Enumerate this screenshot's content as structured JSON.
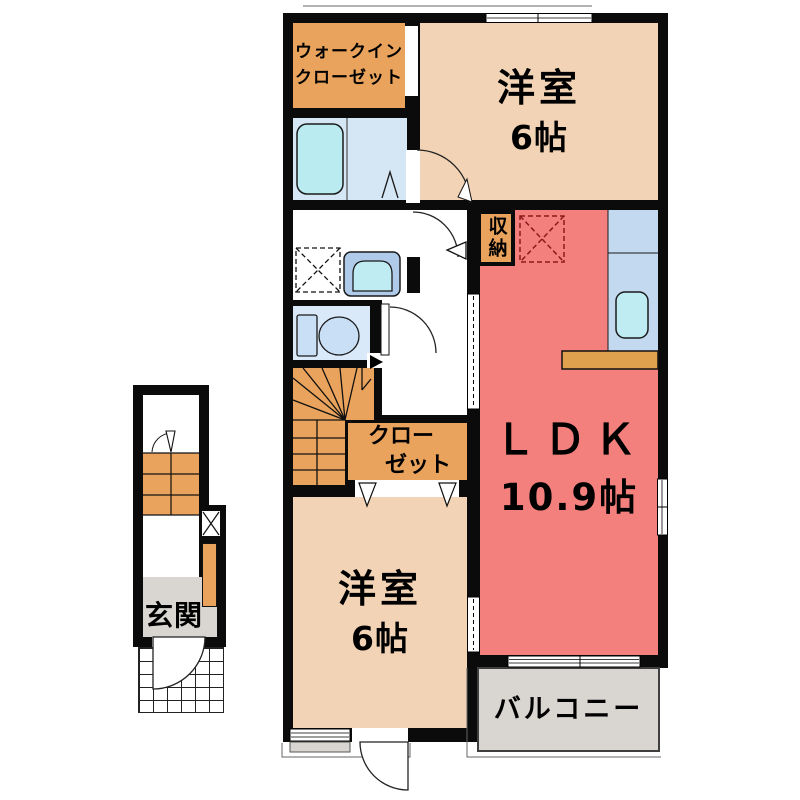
{
  "plan": {
    "walk_in_closet_line1": "ウォークイン",
    "walk_in_closet_line2": "クローゼット",
    "bedroom_top_name": "洋室",
    "bedroom_top_size": "6帖",
    "storage_label": "収納",
    "ldk_name": "ＬＤＫ",
    "ldk_size": "10.9帖",
    "closet_line1": "クロー",
    "closet_line2": "ゼット",
    "bedroom_bottom_name": "洋室",
    "bedroom_bottom_size": "6帖",
    "balcony_label": "バルコニー",
    "entrance_label": "玄関"
  },
  "colors": {
    "wall": "#0b0b0b",
    "bedroom_peach": "#F2D3B5",
    "ldk_salmon": "#F4807D",
    "closet_orange": "#E9A35C",
    "counter_orange": "#E0A14F",
    "bath_blue": "#D5E6F5",
    "toilet_blue": "#D9E9F9",
    "kitchen_blue": "#C3D9F0",
    "fixture_cyan": "#B9EBF1",
    "entrance_gray": "#D9D6D1",
    "fridge_dash_red": "#8B1A1A"
  }
}
